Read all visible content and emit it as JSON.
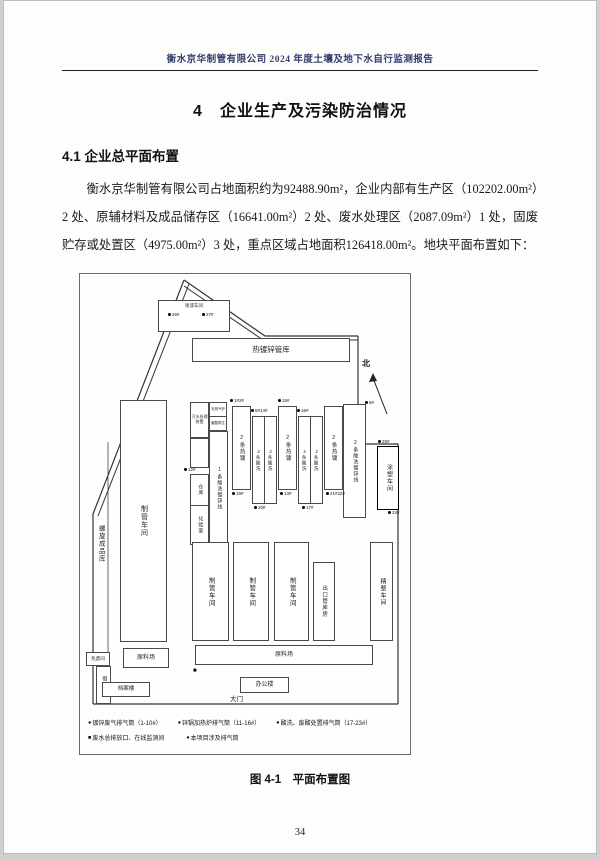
{
  "doc": {
    "header_title": "衡水京华制管有限公司 2024 年度土壤及地下水自行监测报告",
    "section_heading": "4　企业生产及污染防治情况",
    "subsection_heading": "4.1  企业总平面布置",
    "paragraph": "衡水京华制管有限公司占地面积约为92488.90m²，企业内部有生产区（102202.00m²）2 处、原辅材料及成品储存区（16641.00m²）2 处、废水处理区（2087.09m²）1 处，固废贮存或处置区（4975.00m²）3 处，重点区域占地面积126418.00m²。地块平面布置如下：",
    "figure_caption": "图 4-1　平面布置图",
    "page_number": "34"
  },
  "fig": {
    "north": "北",
    "gate": "大门",
    "outlet_marker": "■",
    "buildings": {
      "paint_shop": "喷漆车间",
      "galv_pipe_warehouse": "热镀锌管库",
      "spiral_product_warehouse": "螺旋成品库",
      "pipe_shop": "制管车间",
      "sewage_unit": "污水处理装置",
      "gas_furnace": "天然气炉",
      "acid_regen": "废酸再生",
      "pickling_galv_line_1": "1条酸洗镀锌线",
      "hot_galv_2": "2条热镀",
      "pickling_2": "2条酸洗",
      "pickling_galv_line_2": "2条酸洗镀锌线",
      "coating_shop": "涂塑车间",
      "warehouse": "仓库",
      "lab": "化验室",
      "export_pipe_warehouse": "出口管库房",
      "finishing_shop": "精整车间",
      "hazardous_waste_room": "危废间",
      "dormitory": "宿舍楼",
      "raw_material_yard": "原料场",
      "archive_building": "档案楼",
      "office_building": "办公楼"
    },
    "dots": [
      "26#",
      "27#",
      "12#",
      "1#2#",
      "5#14#",
      "15#",
      "16#",
      "19#",
      "20#",
      "13#",
      "17#",
      "21#22#",
      "6#",
      "25#",
      "24#"
    ],
    "legend": {
      "markers": [
        "●",
        "●",
        "●",
        "■",
        "●"
      ],
      "items": [
        "镀锌废气排气筒（1-10#）",
        "锌锅加热炉排气筒（11-16#）",
        "酸洗、废酸处置排气筒（17-23#）",
        "废水总排放口、在线监测间",
        "本项目涉及排气筒"
      ]
    }
  }
}
